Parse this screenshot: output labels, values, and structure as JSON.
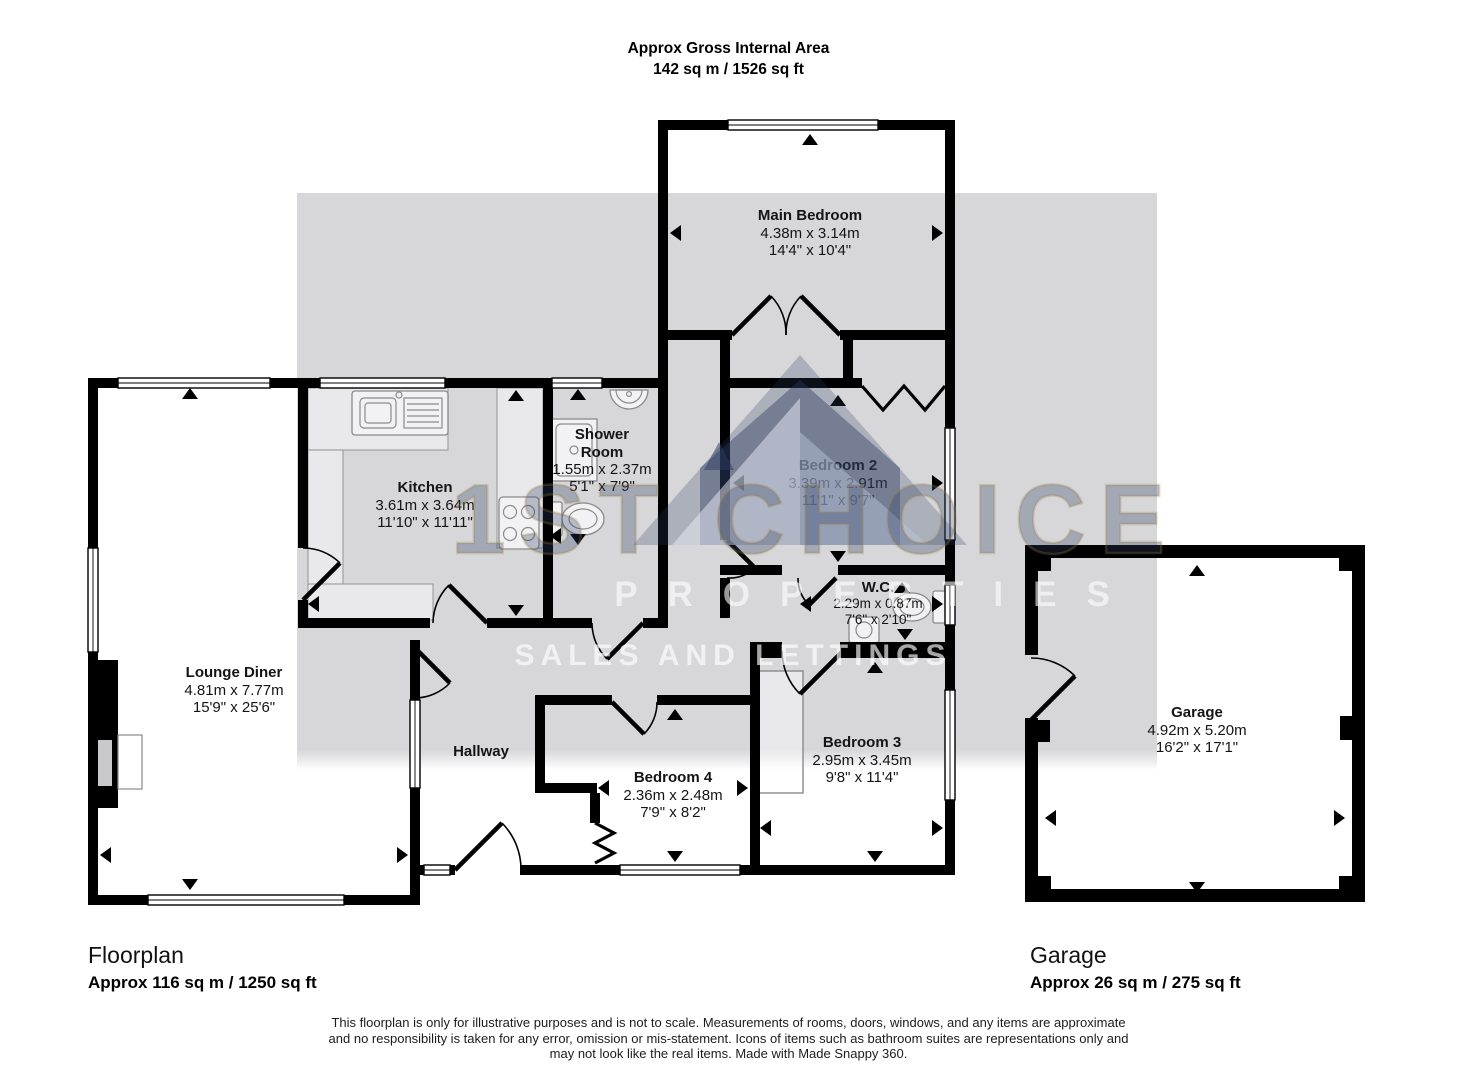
{
  "header": {
    "line1": "Approx Gross Internal Area",
    "line2": "142 sq m / 1526 sq ft"
  },
  "rooms": {
    "main_bedroom": {
      "name": "Main Bedroom",
      "metric": "4.38m x 3.14m",
      "imperial": "14'4\" x 10'4\""
    },
    "kitchen": {
      "name": "Kitchen",
      "metric": "3.61m x 3.64m",
      "imperial": "11'10\" x 11'11\""
    },
    "shower_room": {
      "name1": "Shower",
      "name2": "Room",
      "metric": "1.55m x 2.37m",
      "imperial": "5'1\" x 7'9\""
    },
    "bedroom2": {
      "name": "Bedroom 2",
      "metric": "3.39m x 2.91m",
      "imperial": "11'1\" x 9'7\""
    },
    "wc": {
      "name": "W.C.",
      "metric": "2.29m x 0.87m",
      "imperial": "7'6\" x 2'10\""
    },
    "lounge_diner": {
      "name": "Lounge Diner",
      "metric": "4.81m x 7.77m",
      "imperial": "15'9\" x 25'6\""
    },
    "hallway": {
      "name": "Hallway"
    },
    "bedroom4": {
      "name": "Bedroom 4",
      "metric": "2.36m x 2.48m",
      "imperial": "7'9\" x 8'2\""
    },
    "bedroom3": {
      "name": "Bedroom 3",
      "metric": "2.95m x 3.45m",
      "imperial": "9'8\" x 11'4\""
    },
    "garage": {
      "name": "Garage",
      "metric": "4.92m x 5.20m",
      "imperial": "16'2\" x 17'1\""
    }
  },
  "watermark": {
    "line1": "1ST CHOICE",
    "line2": "PROPERTIES",
    "line3": "SALES AND LETTINGS"
  },
  "footer": {
    "floorplan_label": "Floorplan",
    "floorplan_area": "Approx 116 sq m / 1250 sq ft",
    "garage_label": "Garage",
    "garage_area": "Approx 26 sq m / 275 sq ft",
    "disclaimer_line1": "This floorplan is only for illustrative purposes and is not to scale. Measurements of rooms, doors, windows, and any items are approximate",
    "disclaimer_line2": "and no responsibility is taken for any error, omission or mis-statement. Icons of items such as bathroom suites are representations only and",
    "disclaimer_line3": "may not look like the real items. Made with Made Snappy 360."
  },
  "colors": {
    "wall": "#000000",
    "watermark_band": "#d7d7da",
    "brand_navy": "#2a3a60",
    "brand_gold": "#9a8248"
  }
}
